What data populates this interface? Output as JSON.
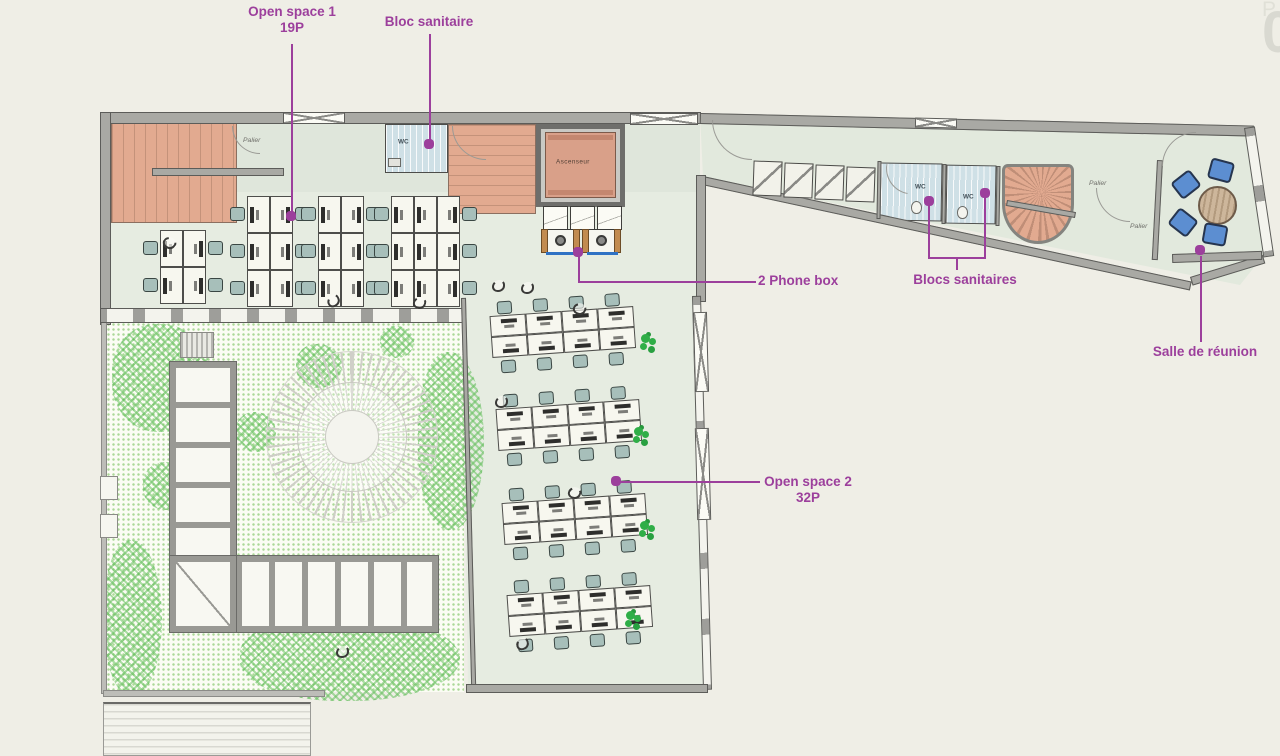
{
  "watermark": {
    "number": "01",
    "label": "PLAN"
  },
  "colors": {
    "background": "#efeee6",
    "floor": "#e4eadf",
    "wall": "#a9a9a4",
    "wall_edge": "#5c5c59",
    "stairs": "#e2aa90",
    "wc_room": "#cfe0e6",
    "garden_dots": "#abd898",
    "tree_green": "#4cb046",
    "plant_green": "#2fae47",
    "chair_teal": "#a7bfba",
    "chair_blue": "#5c8ed1",
    "table_wood": "#cdb69b",
    "elevator_cab": "#d9a089",
    "phone_tan": "#c28b4f",
    "phone_blue": "#2f72c4",
    "accent_purple": "#9c3f9c",
    "watermark_gray": "#d9d9d1"
  },
  "annotations": [
    {
      "name": "open-space-1",
      "lines": [
        "Open space 1",
        "19P"
      ],
      "box": [
        222,
        4,
        140
      ],
      "align": "center",
      "segs": [
        [
          291,
          44,
          2,
          169
        ]
      ],
      "dots": [
        [
          286,
          211
        ]
      ]
    },
    {
      "name": "bloc-sanitaire",
      "lines": [
        "Bloc sanitaire"
      ],
      "box": [
        363,
        14,
        132
      ],
      "align": "center",
      "segs": [
        [
          429,
          34,
          2,
          106
        ]
      ],
      "dots": [
        [
          424,
          139
        ]
      ]
    },
    {
      "name": "2-phone-box",
      "lines": [
        "2 Phone box"
      ],
      "box": [
        758,
        273,
        140
      ],
      "align": "left",
      "segs": [
        [
          578,
          281,
          178,
          2
        ],
        [
          578,
          254,
          2,
          28
        ]
      ],
      "dots": [
        [
          573,
          247
        ]
      ]
    },
    {
      "name": "blocs-sanitaires",
      "lines": [
        "Blocs sanitaires"
      ],
      "box": [
        895,
        272,
        140
      ],
      "align": "center",
      "segs": [
        [
          928,
          206,
          2,
          52
        ],
        [
          984,
          198,
          2,
          60
        ],
        [
          928,
          257,
          58,
          2
        ],
        [
          956,
          257,
          2,
          13
        ]
      ],
      "dots": [
        [
          924,
          196
        ],
        [
          980,
          188
        ]
      ]
    },
    {
      "name": "open-space-2",
      "lines": [
        "Open space 2",
        "32P"
      ],
      "box": [
        742,
        474,
        132
      ],
      "align": "center",
      "segs": [
        [
          620,
          481,
          140,
          2
        ]
      ],
      "dots": [
        [
          611,
          476
        ]
      ]
    },
    {
      "name": "salle-de-reunion",
      "lines": [
        "Salle de réunion"
      ],
      "box": [
        1130,
        344,
        150
      ],
      "align": "center",
      "segs": [
        [
          1200,
          256,
          2,
          86
        ]
      ],
      "dots": [
        [
          1195,
          245
        ]
      ]
    }
  ],
  "plan_labels": [
    {
      "text": "Palier",
      "x": 243,
      "y": 136,
      "style": "palier"
    },
    {
      "text": "Palier",
      "x": 1089,
      "y": 179,
      "style": "palier"
    },
    {
      "text": "Palier",
      "x": 1130,
      "y": 222,
      "style": "palier"
    },
    {
      "text": "WC",
      "x": 398,
      "y": 138,
      "style": "wc"
    },
    {
      "text": "WC",
      "x": 915,
      "y": 183,
      "style": "wc"
    },
    {
      "text": "WC",
      "x": 963,
      "y": 193,
      "style": "wc"
    },
    {
      "text": "Ascenseur",
      "x": 556,
      "y": 158,
      "style": "ascenseur"
    }
  ],
  "open_space_1": {
    "benches": [
      {
        "x": 160,
        "y": 230,
        "cols": 2,
        "rows": 2
      },
      {
        "x": 247,
        "y": 196,
        "cols": 2,
        "rows": 3
      },
      {
        "x": 318,
        "y": 196,
        "cols": 2,
        "rows": 3
      },
      {
        "x": 391,
        "y": 196,
        "cols": 3,
        "rows": 3
      }
    ],
    "desk_w": 23,
    "desk_h": 37
  },
  "open_space_2": {
    "benches": [
      {
        "x": 489,
        "y": 297,
        "rot": -4
      },
      {
        "x": 495,
        "y": 390,
        "rot": -4
      },
      {
        "x": 501,
        "y": 484,
        "rot": -4
      },
      {
        "x": 506,
        "y": 576,
        "rot": -4
      }
    ],
    "cols": 4,
    "desk_w": 36,
    "desk_h": 21
  },
  "plants": [
    [
      641,
      334
    ],
    [
      634,
      427
    ],
    [
      640,
      521
    ],
    [
      626,
      611
    ]
  ],
  "figures": [
    [
      163,
      237,
      40
    ],
    [
      327,
      295,
      -25
    ],
    [
      413,
      297,
      15
    ],
    [
      573,
      303,
      30
    ],
    [
      495,
      396,
      0
    ],
    [
      568,
      487,
      20
    ],
    [
      336,
      646,
      0
    ],
    [
      516,
      638,
      -15
    ],
    [
      492,
      280,
      0
    ],
    [
      521,
      282,
      0
    ]
  ],
  "trees": [
    [
      112,
      324,
      100,
      108
    ],
    [
      418,
      352,
      66,
      178
    ],
    [
      240,
      615,
      220,
      86
    ],
    [
      104,
      540,
      58,
      156
    ],
    [
      296,
      344,
      46,
      44
    ],
    [
      236,
      412,
      40,
      40
    ],
    [
      143,
      462,
      50,
      48
    ],
    [
      380,
      326,
      34,
      32
    ],
    [
      327,
      560,
      60,
      50
    ]
  ],
  "lockers": {
    "x": 753,
    "y": 161,
    "count": 4,
    "w": 29,
    "h": 35,
    "dx": 31,
    "dy": 2
  },
  "closets": {
    "x": 543,
    "y": 206,
    "count": 3,
    "w": 25,
    "h": 24,
    "dx": 27
  },
  "phone_boxes": {
    "x": 541,
    "y": 229,
    "count": 2,
    "w": 39,
    "h": 24,
    "dx": 41
  },
  "meeting_room": {
    "table": [
      1198,
      186,
      39
    ],
    "chairs": [
      [
        1209,
        160,
        15
      ],
      [
        1174,
        174,
        -38
      ],
      [
        1171,
        212,
        38
      ],
      [
        1203,
        224,
        10
      ]
    ]
  },
  "toilets": [
    [
      911,
      201
    ],
    [
      957,
      206
    ]
  ],
  "arcs": [
    [
      452,
      126,
      34,
      0
    ],
    [
      712,
      120,
      40,
      0
    ],
    [
      884,
      166,
      26,
      10
    ],
    [
      1096,
      188,
      34,
      0
    ],
    [
      1162,
      132,
      34,
      90
    ],
    [
      232,
      126,
      28,
      0
    ]
  ],
  "xwindows": [
    [
      283,
      112,
      62,
      12,
      0
    ],
    [
      630,
      113,
      68,
      12,
      0
    ],
    [
      694,
      312,
      14,
      80,
      -1.5
    ],
    [
      696,
      428,
      14,
      92,
      -1.5
    ],
    [
      915,
      118,
      42,
      10,
      1.3
    ]
  ]
}
